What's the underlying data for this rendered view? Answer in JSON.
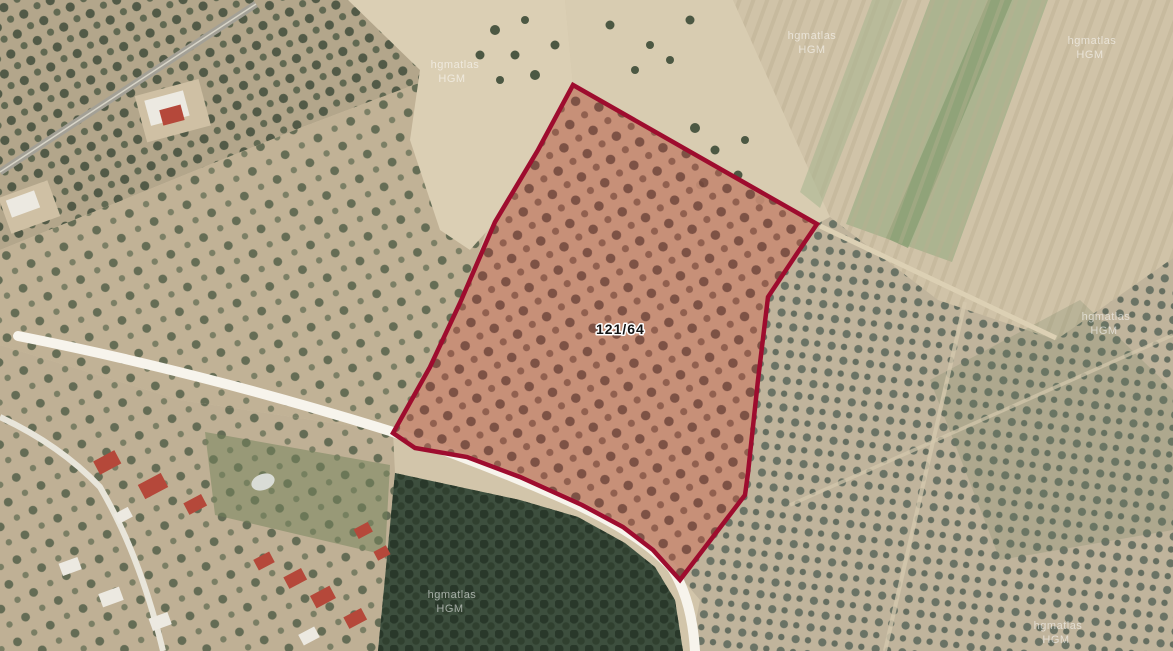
{
  "map": {
    "parcel": {
      "id_label": "121/64",
      "outline_color": "#9e0c2e",
      "ground_color": "#c68b74"
    },
    "watermark": {
      "line1": "hgmatlas",
      "line2": "HGM"
    },
    "colors": {
      "road_white": "#f7f4ec",
      "road_grey": "#a3a096",
      "bare_field": "#d8ccb1",
      "dark_grove": "#3d4f3e"
    }
  }
}
